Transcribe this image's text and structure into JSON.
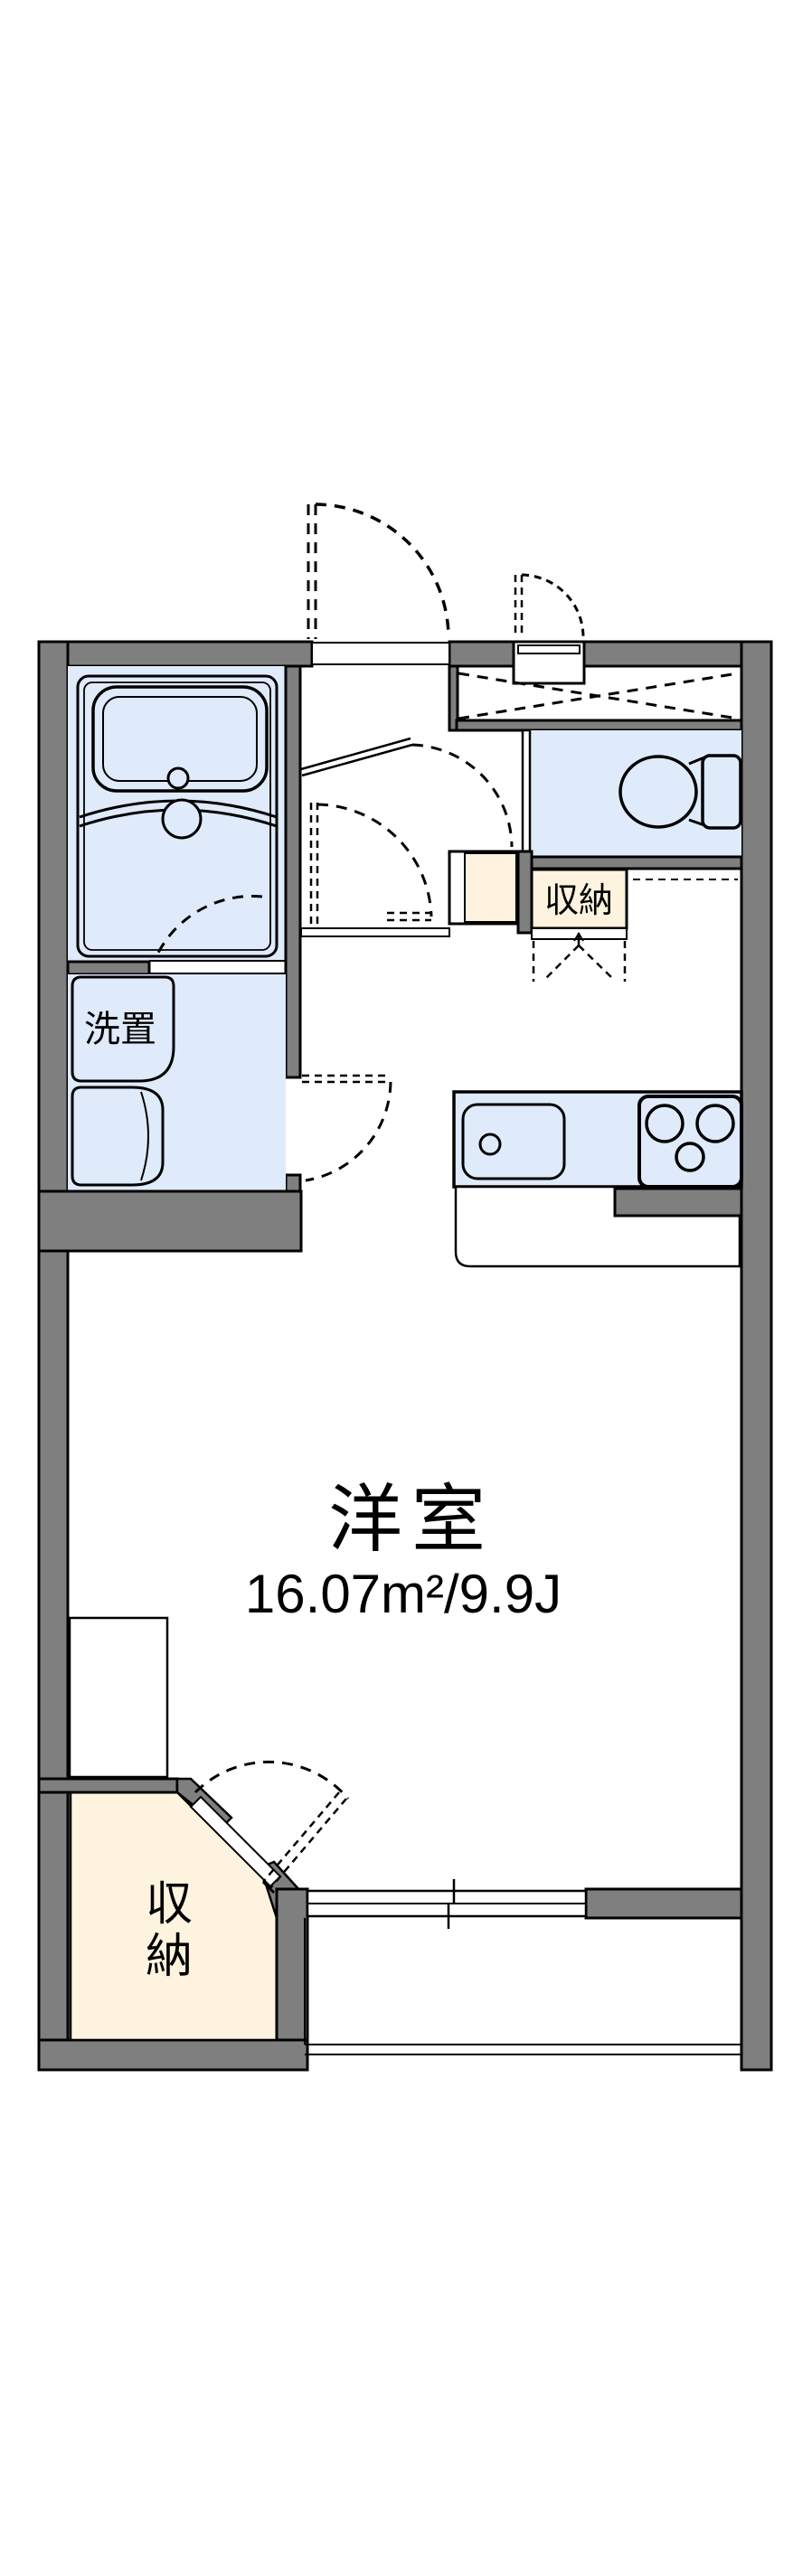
{
  "colors": {
    "wall": "#7f7f7f",
    "floor": "#dfeafa",
    "storage": "#fdf3de",
    "line": "#000000",
    "bg": "#ffffff"
  },
  "plan": {
    "main_room": {
      "name": "洋室",
      "area": "16.07m²/9.9J"
    },
    "washer_area": {
      "label": "洗置"
    },
    "hall_storage": {
      "label": "収納"
    },
    "closet": {
      "chars": [
        "収",
        "納"
      ]
    }
  }
}
